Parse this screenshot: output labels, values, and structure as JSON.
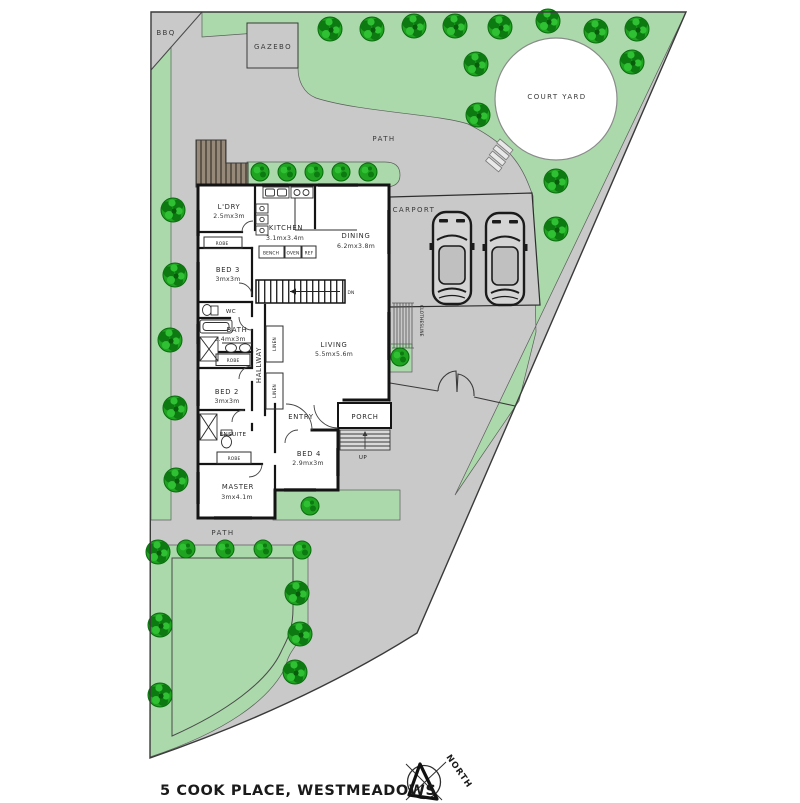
{
  "address": "5 COOK PLACE, WESTMEADOWS",
  "compass": {
    "north": "NORTH"
  },
  "outdoor": {
    "bbq": "BBQ",
    "gazebo": "GAZEBO",
    "courtyard": "COURT YARD",
    "path_top": "PATH",
    "path_bottom": "PATH",
    "carport": "CARPORT",
    "clothesline": "CLOTHESLINE"
  },
  "rooms": {
    "laundry": {
      "name": "L'DRY",
      "dims": "2.5mx3m"
    },
    "kitchen": {
      "name": "KITCHEN",
      "dims": "3.1mx3.4m"
    },
    "dining": {
      "name": "DINING",
      "dims": "6.2mx3.8m"
    },
    "bed3": {
      "name": "BED 3",
      "dims": "3mx3m"
    },
    "bath": {
      "name": "BATH",
      "dims": "2.4mx3m"
    },
    "bed2": {
      "name": "BED 2",
      "dims": "3mx3m"
    },
    "living": {
      "name": "LIVING",
      "dims": "5.5mx5.6m"
    },
    "bed4": {
      "name": "BED 4",
      "dims": "2.9mx3m"
    },
    "master": {
      "name": "MASTER",
      "dims": "3mx4.1m"
    },
    "ensuite": {
      "name": "ENSUITE"
    },
    "entry": {
      "name": "ENTRY"
    },
    "porch": {
      "name": "PORCH"
    },
    "hallway": {
      "name": "HALLWAY"
    },
    "wc": {
      "name": "WC"
    }
  },
  "fixtures": {
    "robe": "ROBE",
    "linen": "LINEN",
    "bench": "BENCH",
    "oven": "OVEN",
    "ref": "REF",
    "dn": "DN",
    "up": "UP"
  },
  "colors": {
    "paving": "#c9c9c9",
    "garden": "#abd9ab",
    "tree_green": "#1fa321",
    "deck_brown": "#97897a",
    "wall_black": "#141414",
    "courtyard_white": "#ffffff"
  }
}
